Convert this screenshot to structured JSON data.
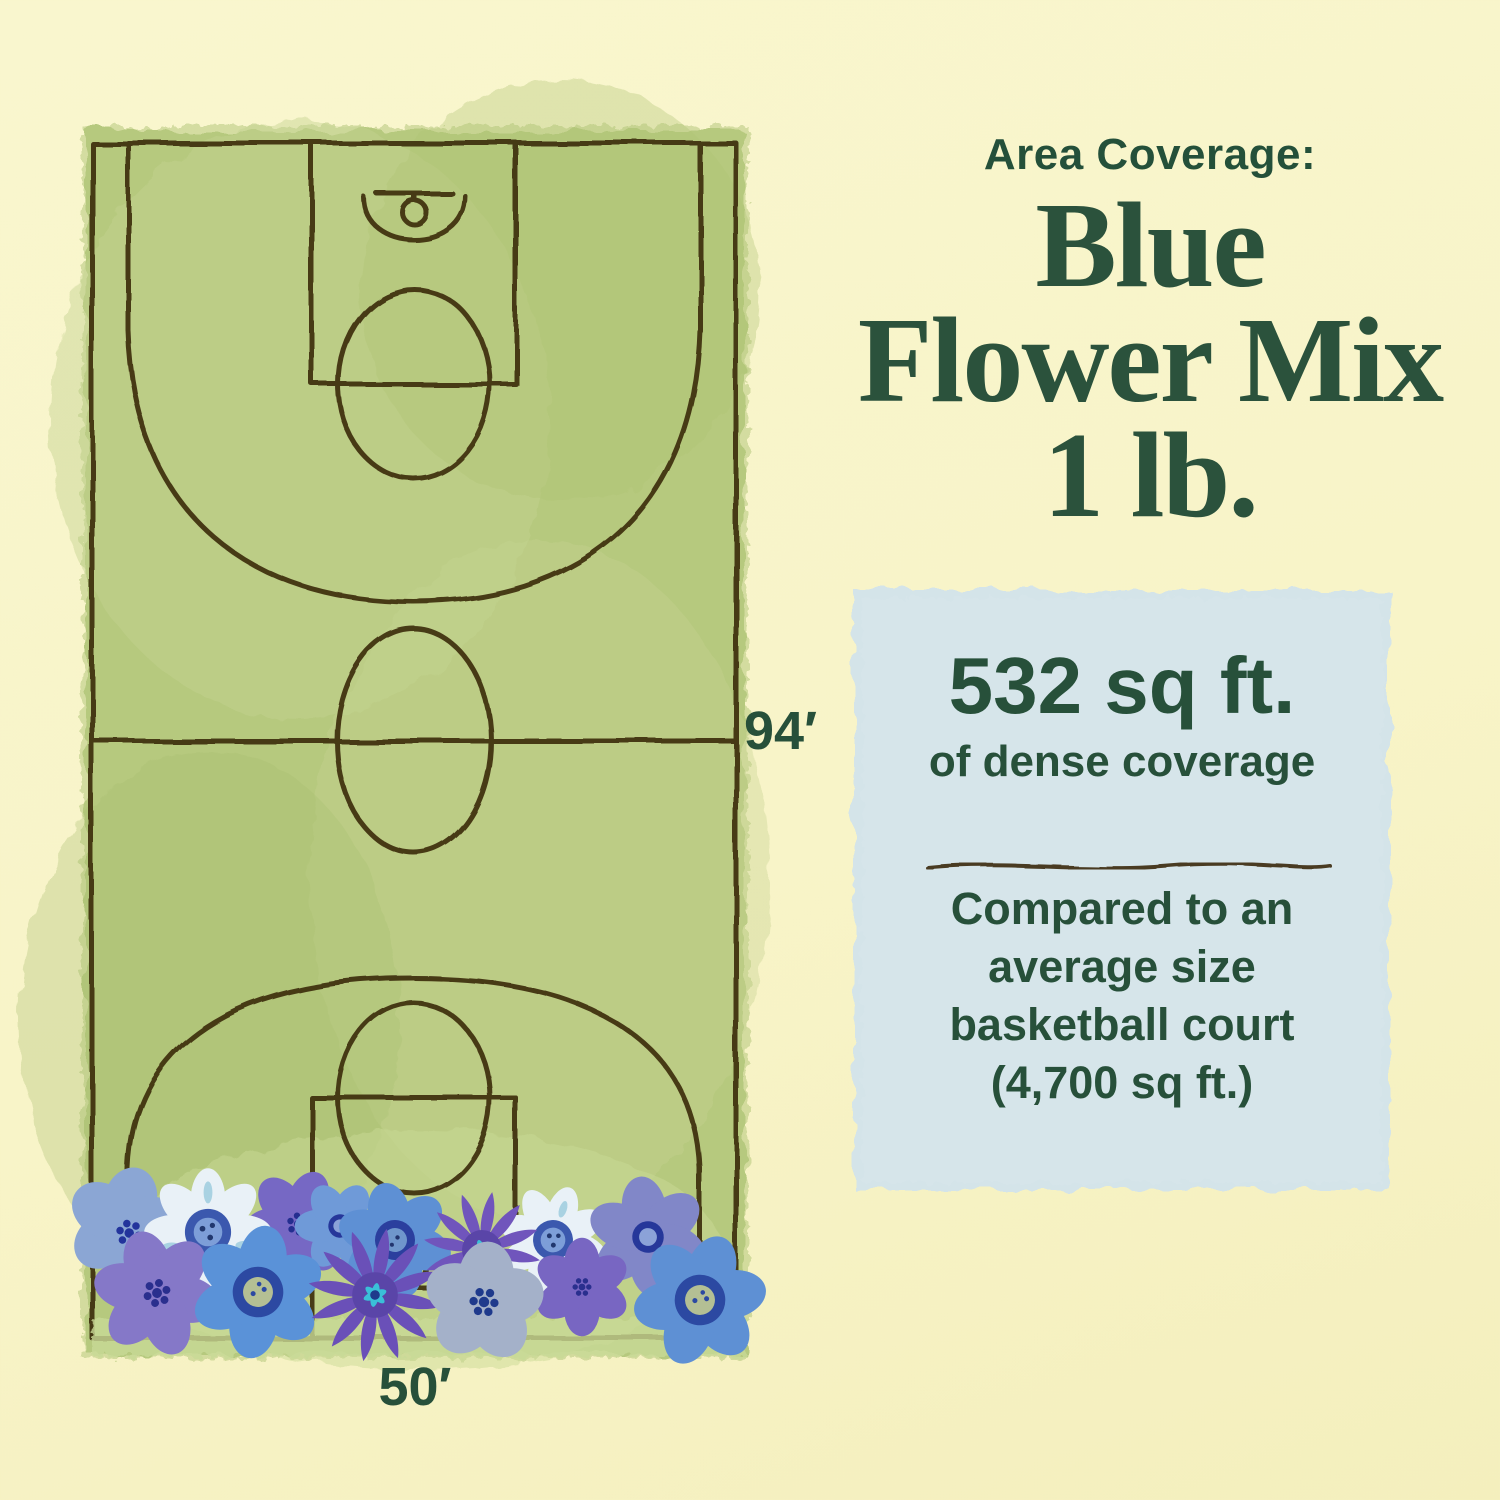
{
  "header": {
    "kicker": "Area Coverage:",
    "title_lines": [
      "Blue",
      "Flower Mix",
      "1 lb."
    ]
  },
  "callout": {
    "area": "532 sq ft.",
    "area_detail": "of dense coverage",
    "comparison_lines": [
      "Compared to an",
      "average size",
      "basketball court",
      "(4,700 sq ft.)"
    ]
  },
  "court": {
    "length_label": "94′",
    "width_label": "50′"
  },
  "colors": {
    "background": "#f8f4c8",
    "ink_green": "#27503a",
    "court_green": "#b6c97e",
    "court_line_brown": "#3e2e11",
    "callout_bg": "#d4e4e9",
    "flower_palette": [
      "#e9f1f7",
      "#8ba6d4",
      "#8578c8",
      "#7668c4",
      "#6a50b8",
      "#5e90d4",
      "#a4b1c9",
      "#8187c8"
    ]
  }
}
